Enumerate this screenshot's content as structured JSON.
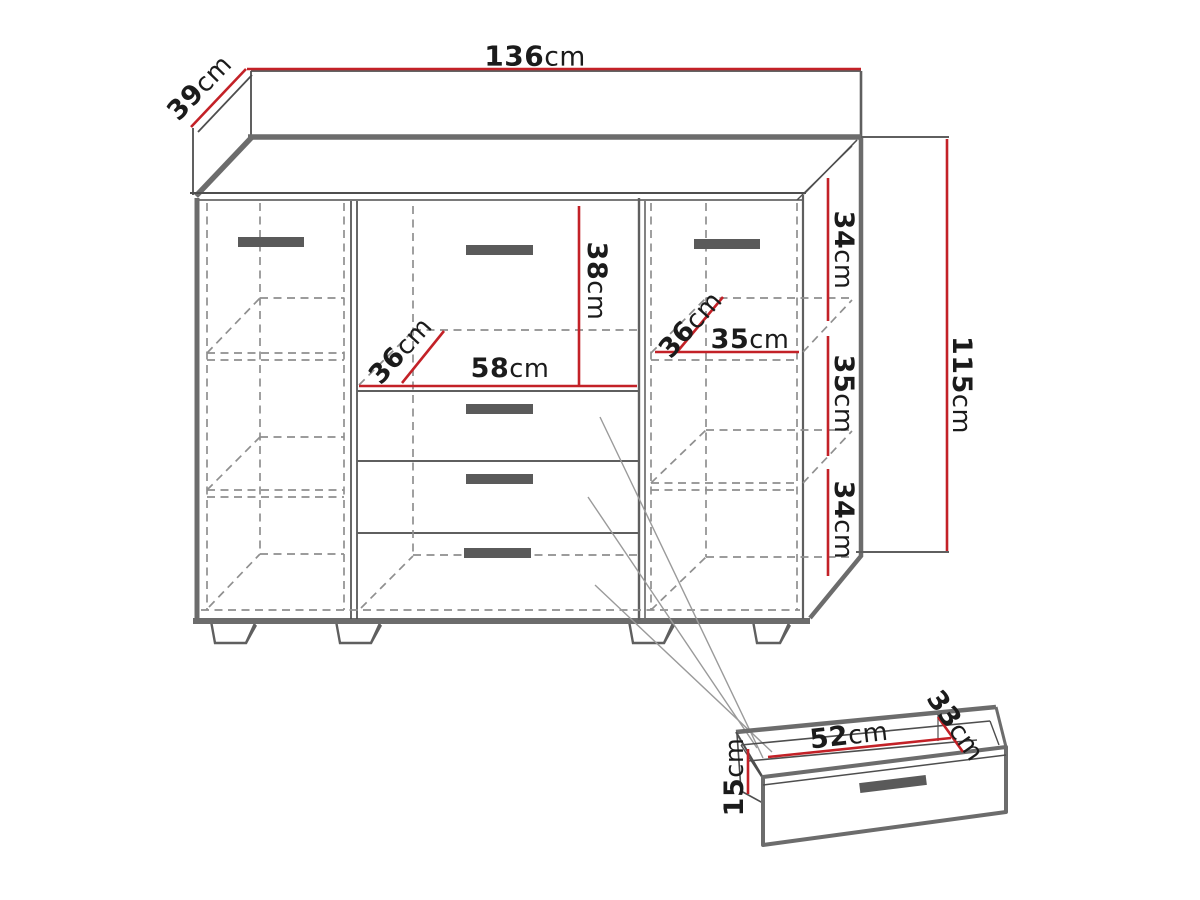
{
  "diagram": {
    "kind": "furniture-dimension-drawing",
    "subject": "three-section sideboard with two doors, four drawers and pull-out drawer detail",
    "units": "cm"
  },
  "labels": {
    "width": {
      "value": "136",
      "unit": "cm"
    },
    "depth": {
      "value": "39",
      "unit": "cm"
    },
    "height": {
      "value": "115",
      "unit": "cm"
    },
    "top_drawer_front": {
      "value": "38",
      "unit": "cm"
    },
    "center_width": {
      "value": "58",
      "unit": "cm"
    },
    "center_depth": {
      "value": "36",
      "unit": "cm"
    },
    "right_depth": {
      "value": "36",
      "unit": "cm"
    },
    "right_width": {
      "value": "35",
      "unit": "cm"
    },
    "right_top": {
      "value": "34",
      "unit": "cm"
    },
    "right_middle": {
      "value": "35",
      "unit": "cm"
    },
    "right_bottom": {
      "value": "34",
      "unit": "cm"
    },
    "drawer_width": {
      "value": "52",
      "unit": "cm"
    },
    "drawer_depth": {
      "value": "33",
      "unit": "cm"
    },
    "drawer_height": {
      "value": "15",
      "unit": "cm"
    }
  },
  "palette": {
    "dimension_red": "#c32127",
    "outline_thin": "#4e4e4e",
    "outline_medium": "#5f5f5f",
    "outline_thick": "#6c6c6c",
    "hidden_dashed": "#8f8f8f",
    "handle_fill": "#5a5a5a",
    "leader_gray": "#9a9a9a",
    "background": "#ffffff"
  }
}
